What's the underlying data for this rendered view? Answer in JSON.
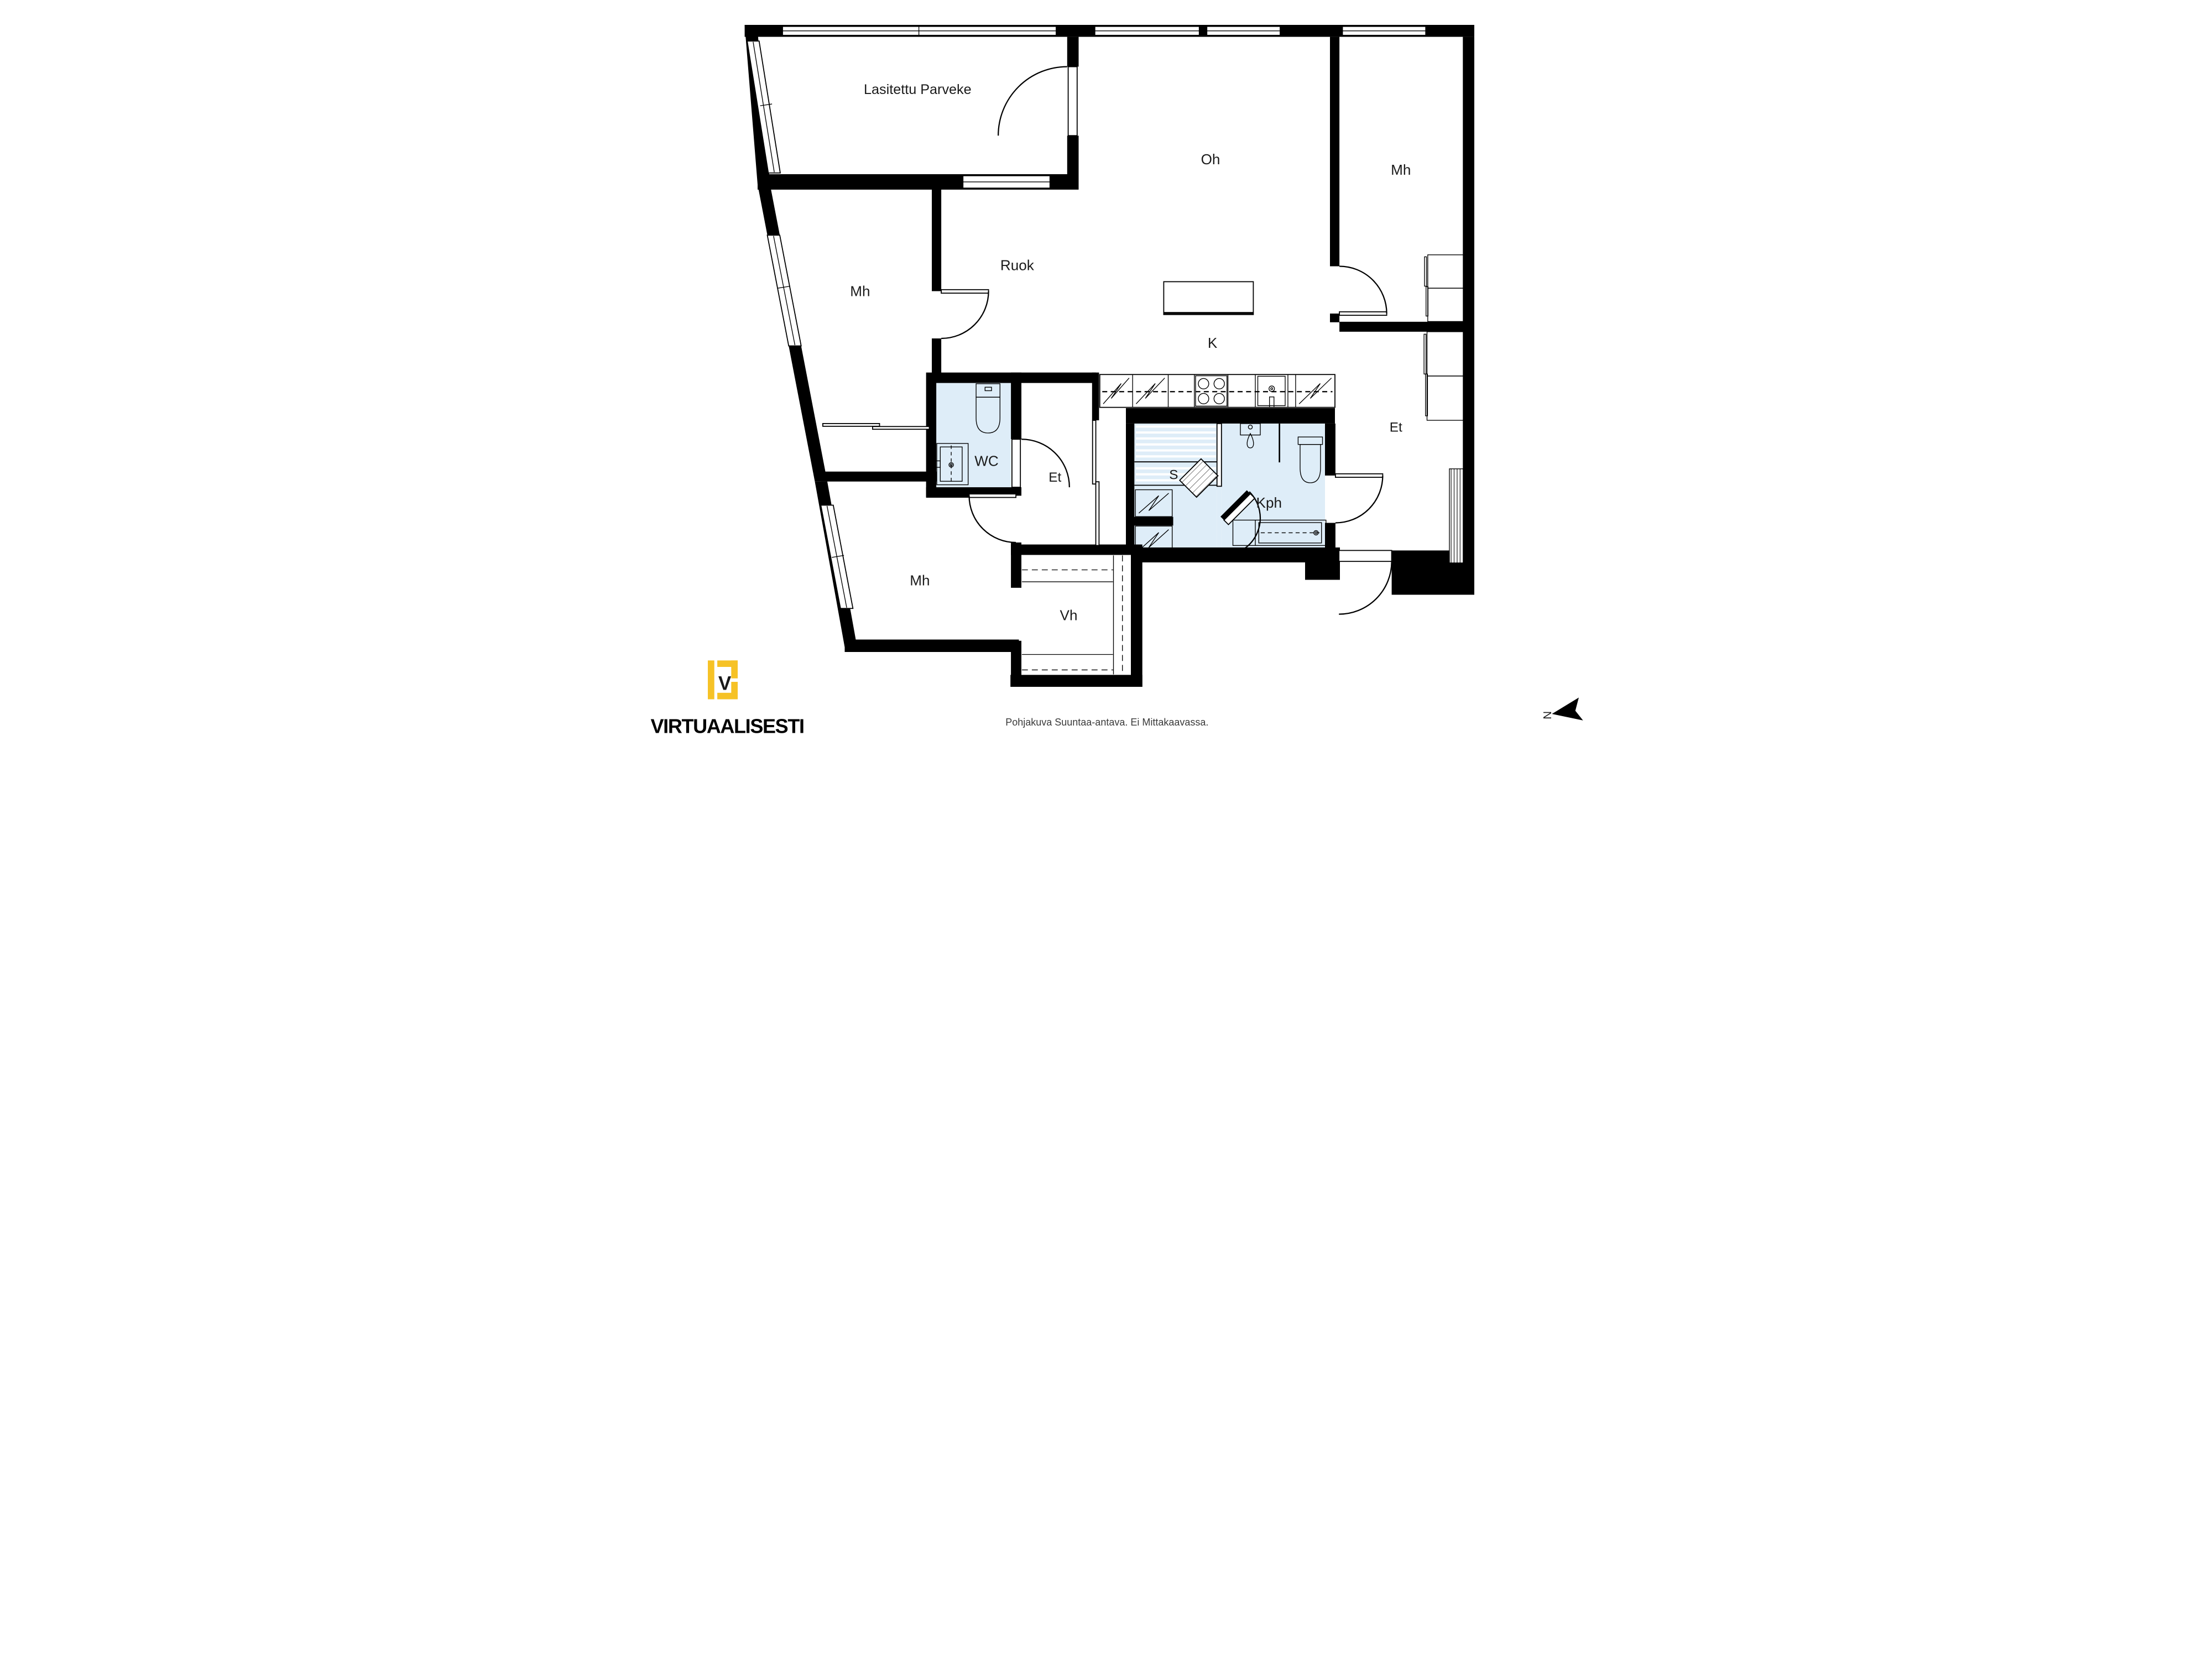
{
  "document": {
    "kind": "floor-plan"
  },
  "rooms": [
    {
      "key": "balcony",
      "label": "Lasitettu Parveke"
    },
    {
      "key": "living_room",
      "label": "Oh"
    },
    {
      "key": "bedroom_top_right",
      "label": "Mh"
    },
    {
      "key": "dining",
      "label": "Ruok"
    },
    {
      "key": "bedroom_left",
      "label": "Mh"
    },
    {
      "key": "kitchen",
      "label": "K"
    },
    {
      "key": "wc",
      "label": "WC"
    },
    {
      "key": "hall_center",
      "label": "Et"
    },
    {
      "key": "sauna",
      "label": "S"
    },
    {
      "key": "bathroom",
      "label": "Kph"
    },
    {
      "key": "hall_right",
      "label": "Et"
    },
    {
      "key": "bedroom_bottom_left",
      "label": "Mh"
    },
    {
      "key": "walk_in_closet",
      "label": "Vh"
    }
  ],
  "branding": {
    "name": "VIRTUAALISESTI",
    "monogram": "V",
    "brand_color": "#F6C226"
  },
  "footer": {
    "disclaimer": "Pohjakuva Suuntaa-antava. Ei Mittakaavassa."
  },
  "compass": {
    "north_label": "N"
  },
  "palette": {
    "wall": "#000000",
    "floor": "#FFFFFF",
    "wet_room": "#DEEDF8",
    "text": "#1A1A1A"
  }
}
